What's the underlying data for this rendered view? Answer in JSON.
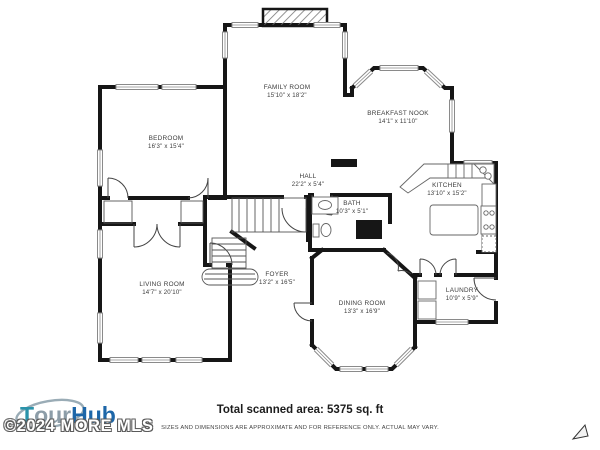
{
  "plan": {
    "rooms": [
      {
        "name": "FAMILY ROOM",
        "dims": "15'10\" x 18'2\""
      },
      {
        "name": "BREAKFAST NOOK",
        "dims": "14'1\" x 11'10\""
      },
      {
        "name": "BEDROOM",
        "dims": "16'3\" x 15'4\""
      },
      {
        "name": "HALL",
        "dims": "22'2\" x 5'4\""
      },
      {
        "name": "KITCHEN",
        "dims": "13'10\" x 15'2\""
      },
      {
        "name": "BATH",
        "dims": "10'3\" x 5'1\""
      },
      {
        "name": "FOYER",
        "dims": "13'2\" x 16'5\""
      },
      {
        "name": "LIVING ROOM",
        "dims": "14'7\" x 20'10\""
      },
      {
        "name": "DINING ROOM",
        "dims": "13'3\" x 16'9\""
      },
      {
        "name": "LAUNDRY",
        "dims": "10'9\" x 5'9\""
      }
    ],
    "wall_color": "#161616",
    "window_color": "#8a8a8a"
  },
  "footer": {
    "area_label": "Total scanned area: 5375 sq. ft",
    "disclaimer": "SIZES AND DIMENSIONS ARE APPROXIMATE AND FOR REFERENCE ONLY. ACTUAL MAY VARY."
  },
  "branding": {
    "logo": {
      "t": "T",
      "our": "our",
      "hub": "Hub"
    },
    "watermark": "©2024 MORE MLS",
    "colors": {
      "teal": "#2b93aa",
      "gray": "#8d9da8",
      "navy": "#1d66a8"
    }
  }
}
